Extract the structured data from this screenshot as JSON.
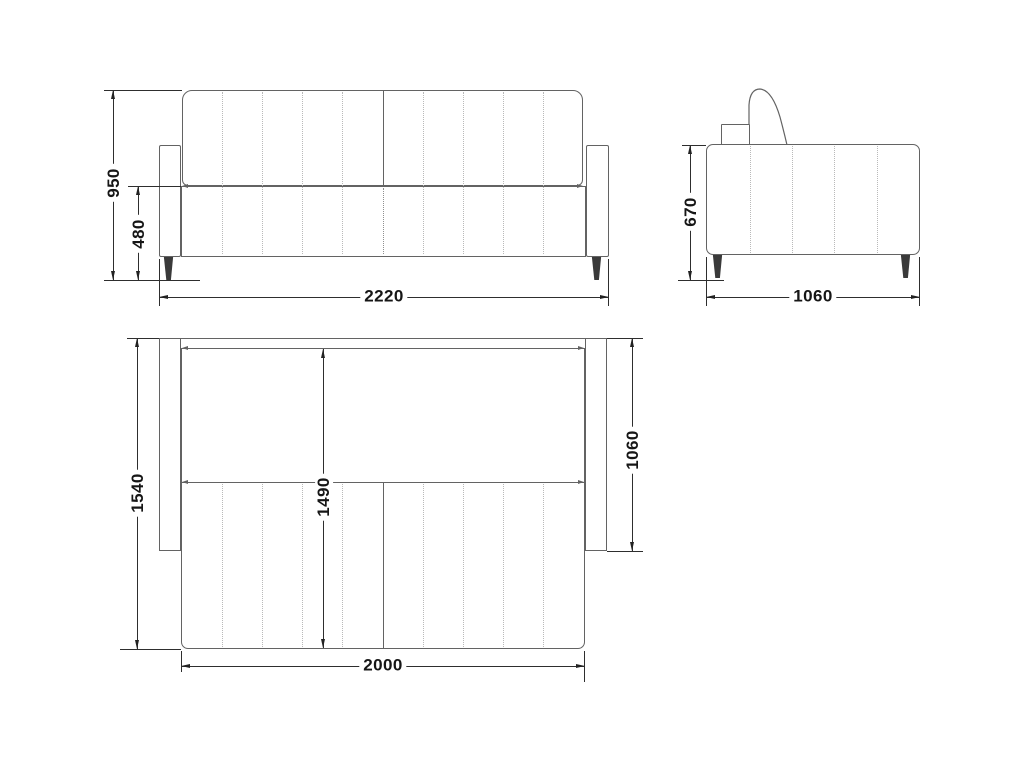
{
  "dims": {
    "front": {
      "height": "950",
      "seat_height": "480",
      "width": "2220"
    },
    "side": {
      "height": "670",
      "depth": "1060"
    },
    "top": {
      "depth_open": "1540",
      "bed_length": "1490",
      "depth": "1060",
      "bed_width": "2000"
    }
  },
  "colors": {
    "outline": "#636363",
    "dimension": "#2e2e2e",
    "text": "#161616",
    "dotted": "#b9b9b9",
    "leg": "#3a3a3a",
    "background": "#ffffff"
  }
}
